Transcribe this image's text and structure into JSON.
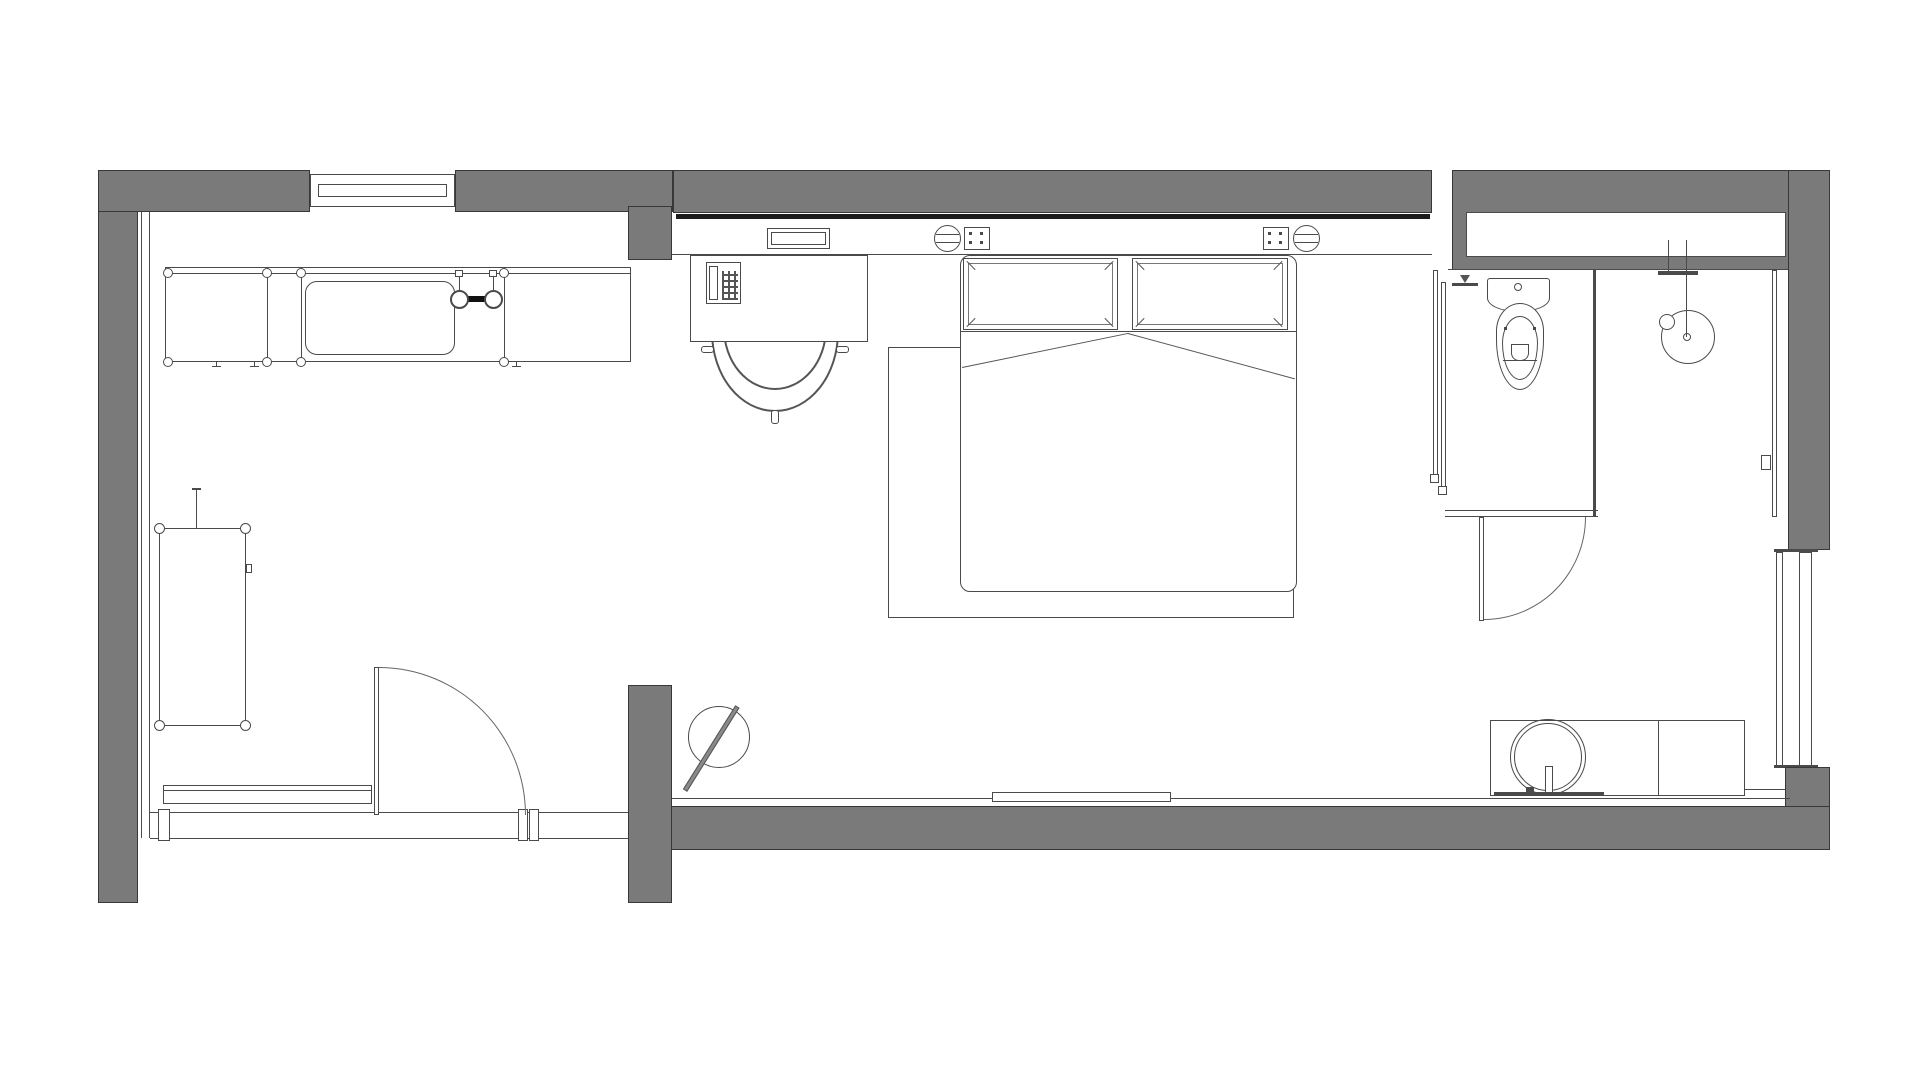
{
  "plan": {
    "type": "architectural-floor-plan",
    "description": "studio hotel room floor plan, top-down line drawing, no text labels",
    "colors": {
      "background": "#ffffff",
      "wall_fill": "#7a7a7a",
      "wall_outline": "#383838",
      "drawing_line": "#4a4a4a",
      "curtain_track": "#1c1c1c"
    },
    "rooms": [
      {
        "name": "kitchen-entry-area",
        "position": "left"
      },
      {
        "name": "bedroom",
        "position": "center"
      },
      {
        "name": "bathroom",
        "position": "top-right"
      }
    ],
    "fixtures": [
      "top-window",
      "kitchen-counter",
      "kitchen-sink",
      "kitchen-faucet",
      "wardrobe-cabinet",
      "coat-stand",
      "entry-bench",
      "entry-door",
      "floor-mirror",
      "desk",
      "telephone",
      "desk-chair",
      "wall-panel",
      "wall-light-left",
      "switch-panel-left",
      "switch-panel-right",
      "wall-light-right",
      "curtain-track",
      "double-bed",
      "pillow-left",
      "pillow-right",
      "rug",
      "floor-step",
      "closet-niche",
      "sliding-glass-partition",
      "shower-valve",
      "toilet",
      "shower-set",
      "shower-partition",
      "bathroom-door",
      "vanity-counter",
      "round-basin",
      "basin-faucet",
      "side-window",
      "entry-threshold"
    ]
  }
}
